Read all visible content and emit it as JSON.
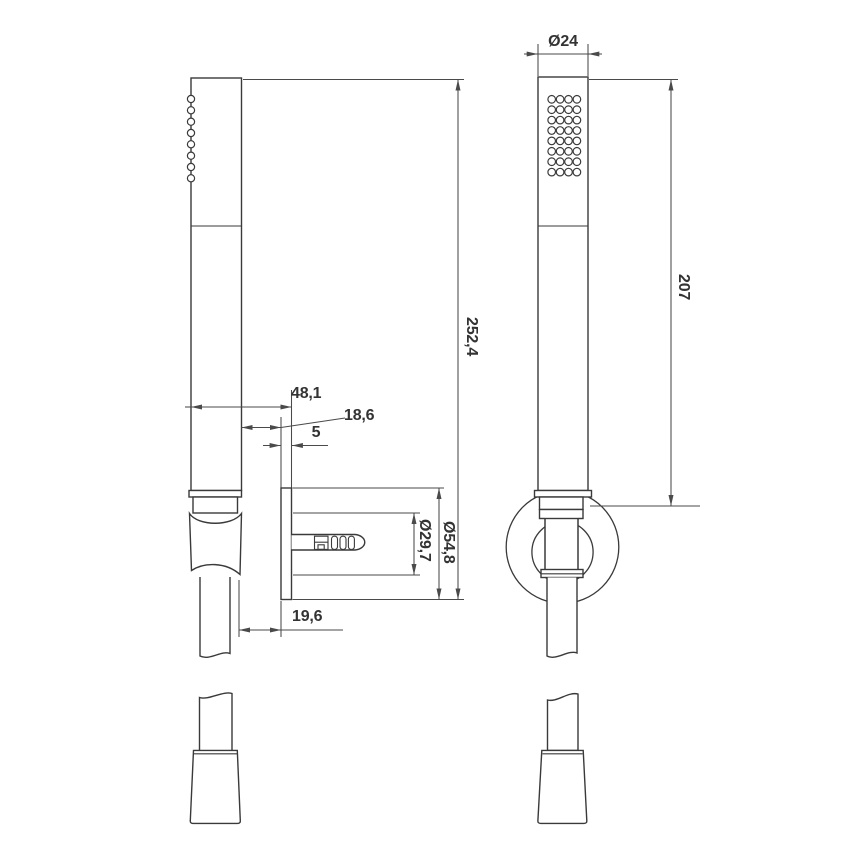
{
  "colors": {
    "background": "#ffffff",
    "object_line": "#3a3a3a",
    "dimension_line": "#4a4a4a",
    "text": "#333333"
  },
  "labels": {
    "head_diameter": "Ø24",
    "handle_length": "207",
    "overall_length": "252,4",
    "bracket_depth": "48,1",
    "wall_clearance": "18,6",
    "plate_thickness": "5",
    "hose_clearance": "19,6",
    "inner_diameter": "Ø29,7",
    "plate_diameter": "Ø54,8"
  }
}
